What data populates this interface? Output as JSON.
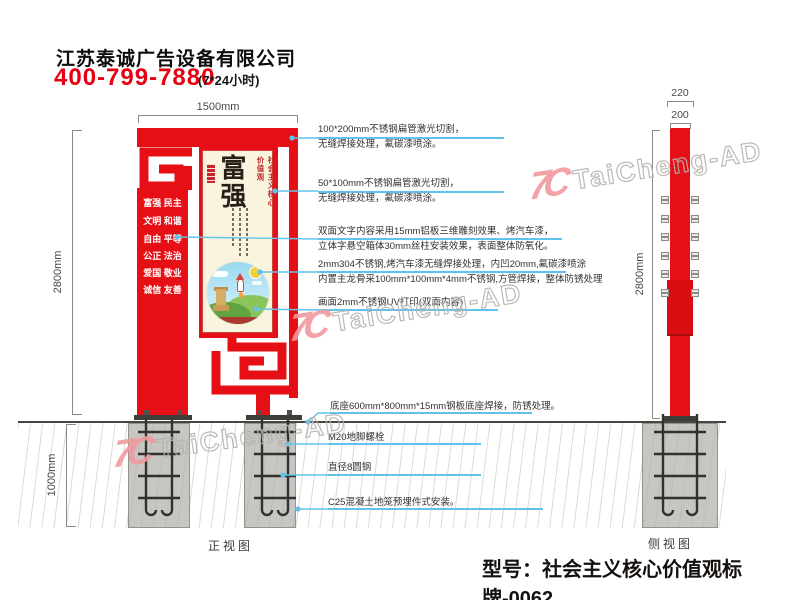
{
  "header": {
    "company": "江苏泰诚广告设备有限公司",
    "phone": "400-799-7880",
    "hours": "(7*24小时)"
  },
  "front_view": {
    "label": "正视图",
    "dim_width": "1500mm",
    "dim_height": "2800mm",
    "dim_foundation": "1000mm",
    "sign": {
      "values": [
        "富强 民主",
        "文明 和谐",
        "自由 平等",
        "公正 法治",
        "爱国 敬业",
        "诚信 友善"
      ],
      "poster": {
        "headline": "富强",
        "side_title": "社会主义核心价值观"
      }
    }
  },
  "side_view": {
    "label": "侧视图",
    "dim_top": "220",
    "dim_pole": "200",
    "dim_height": "2800mm"
  },
  "annotations": [
    {
      "line1": "100*200mm不锈钢扁管激光切割，",
      "line2": "无缝焊接处理，氟碳漆喷涂。"
    },
    {
      "line1": "50*100mm不锈钢扁管激光切割，",
      "line2": "无缝焊接处理，氟碳漆喷涂。"
    },
    {
      "line1": "双面文字内容采用15mm铝板三维雕刻效果、烤汽车漆，",
      "line2": "立体字悬空箱体30mm丝柱安装效果，表面整体防氧化。"
    },
    {
      "line1": "2mm304不锈钢,烤汽车漆无缝焊接处理，内凹20mm,氟碳漆喷涂",
      "line2": "内置主龙骨采100mm*100mm*4mm不锈钢,方管焊接，整体防锈处理"
    },
    {
      "line1": "画面2mm不锈钢UV打印(双面内容)"
    },
    {
      "line1": "底座600mm*800mm*15mm钢板底座焊接，防锈处理。"
    },
    {
      "line1": "M20地脚螺栓"
    },
    {
      "line1": "直径8圆钢"
    },
    {
      "line1": "C25混凝土地笼预埋件式安装。"
    }
  ],
  "footer": {
    "model": "型号：社会主义核心价值观标牌-0062"
  },
  "watermark": {
    "logo": "7C",
    "text": "TaiCheng-AD"
  },
  "colors": {
    "red": "#e60f15",
    "cyan": "#62c3ea",
    "cream": "#f9f4dd",
    "watermark_pink": "#f09a9e",
    "concrete": "#c7c6c2"
  }
}
